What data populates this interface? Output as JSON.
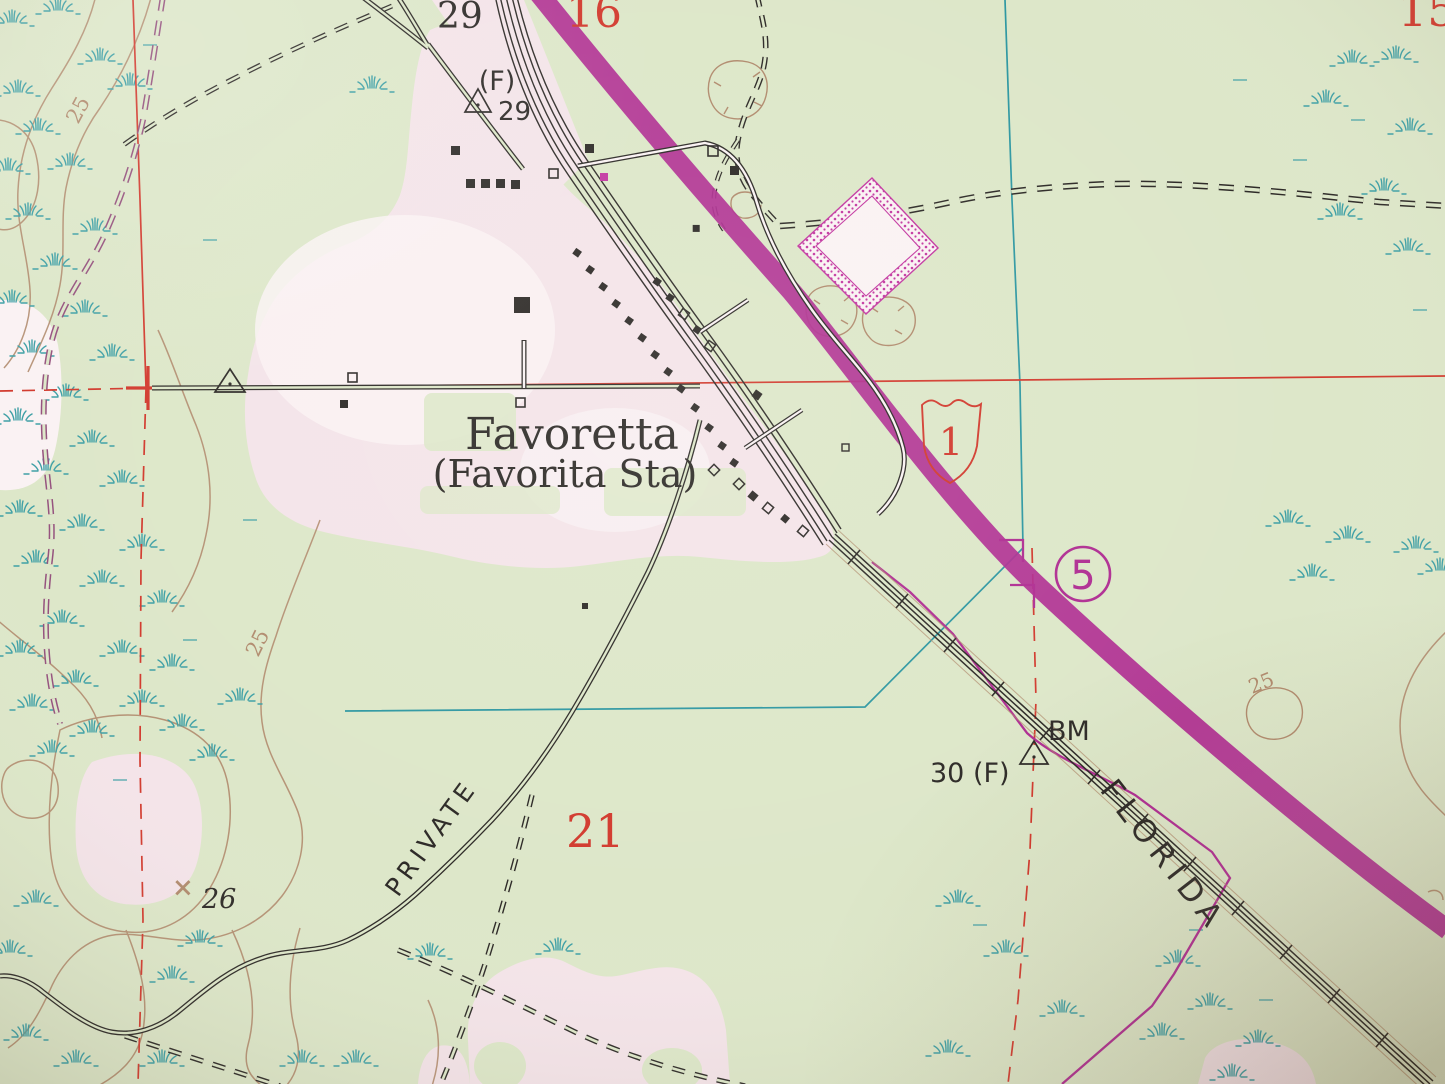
{
  "map": {
    "place": {
      "name": "Favoretta",
      "alt_name": "(Favorita Sta)"
    },
    "roads": {
      "private_label": "PRIVATE",
      "us_route_1": "1",
      "state_route_5": "5"
    },
    "railroad_label": "FLORIDA",
    "survey": {
      "bm": "BM",
      "bm_value": "30 (F)",
      "f_label": "(F)",
      "f_elev": "29",
      "road_elev": "29"
    },
    "sections": {
      "s15": "15",
      "s16": "16",
      "s21": "21"
    },
    "contours": {
      "c25a": "25",
      "c25b": "25",
      "c25c": "25",
      "spot26": "26",
      "spot26_mark": "×"
    },
    "colors": {
      "paper": "#dde7c9",
      "clearpink": "#f4e4e9",
      "clearwhite": "#faf2f3",
      "ink": "#2e2b28",
      "red": "#d23b2f",
      "teal": "#2f98a2",
      "marsh": "#3fa0a6",
      "brown": "#b18b6e",
      "magenta": "#b02f93",
      "purpledash": "#95527e",
      "stipple": "#c338a1"
    }
  }
}
